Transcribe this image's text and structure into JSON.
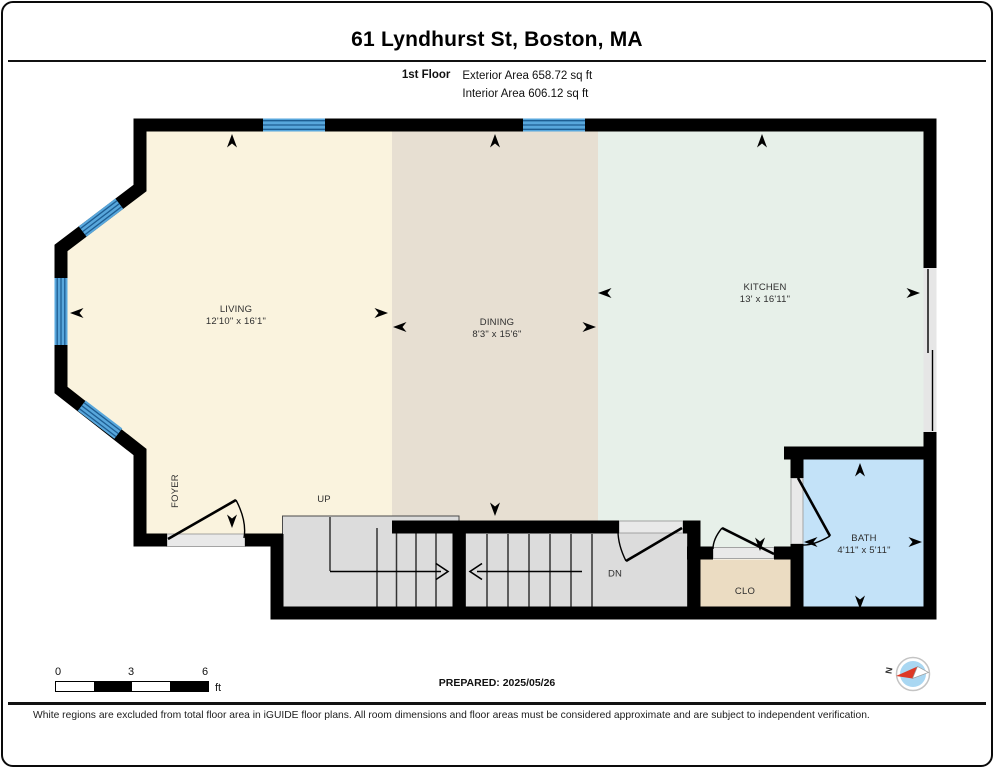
{
  "header": {
    "title": "61 Lyndhurst St, Boston, MA",
    "floor_label": "1st Floor",
    "exterior_area": "Exterior Area 658.72 sq ft",
    "interior_area": "Interior Area 606.12 sq ft"
  },
  "rooms": {
    "living": {
      "name": "LIVING",
      "dims": "12'10\" x 16'1\""
    },
    "dining": {
      "name": "DINING",
      "dims": "8'3\" x 15'6\""
    },
    "kitchen": {
      "name": "KITCHEN",
      "dims": "13' x 16'11\""
    },
    "bath": {
      "name": "BATH",
      "dims": "4'11\" x 5'11\""
    },
    "foyer": {
      "name": "FOYER"
    },
    "closet": {
      "name": "CLO"
    }
  },
  "stairs": {
    "up_label": "UP",
    "down_label": "DN"
  },
  "scale_bar": {
    "ticks": [
      "0",
      "3",
      "6"
    ],
    "unit": "ft"
  },
  "compass": {
    "north_label": "N"
  },
  "footer": {
    "prepared": "PREPARED: 2025/05/26",
    "disclaimer": "White regions are excluded from total floor area in iGUIDE floor plans. All room dimensions and floor areas must be considered approximate and are subject to independent verification."
  },
  "colors": {
    "living_floor": "#FAF3DE",
    "dining_floor": "#E7DFD2",
    "kitchen_floor": "#E7F0E9",
    "bath_floor": "#C3E2F8",
    "closet_floor": "#EBDCC2",
    "stairs": "#DCDCDC",
    "window_blue": "#58A7DC",
    "wall": "#000000",
    "compass_needle_red": "#DD3826"
  }
}
